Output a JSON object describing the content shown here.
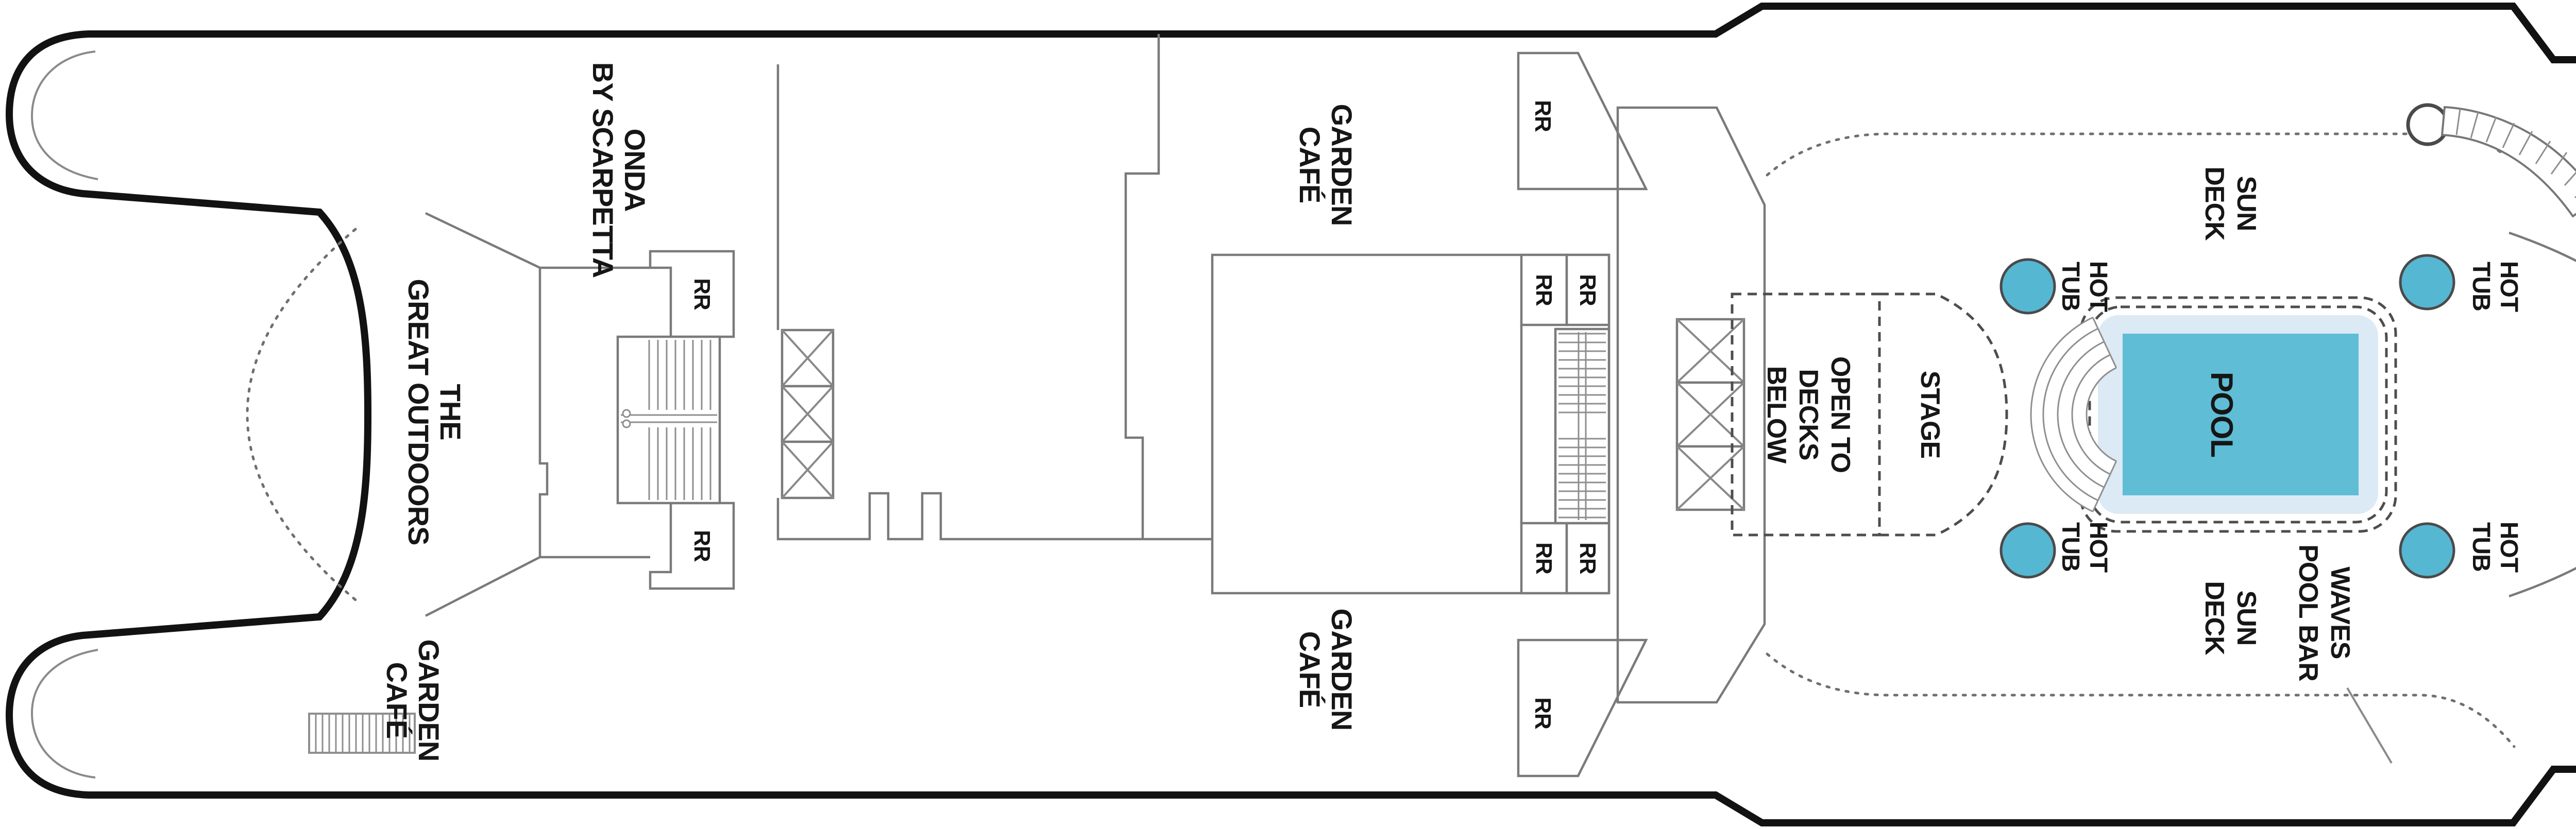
{
  "labels": {
    "onda": [
      "ONDA",
      "BY SCARPETTA"
    ],
    "great_outdoors": [
      "THE",
      "GREAT OUTDOORS"
    ],
    "garden_cafe": [
      "GARDEN",
      "CAFÉ"
    ],
    "restroom": "RR",
    "open_to_decks_below": [
      "OPEN TO",
      "DECKS",
      "BELOW"
    ],
    "stage": "STAGE",
    "pool": "POOL",
    "sun_deck": [
      "SUN",
      "DECK"
    ],
    "hot_tub": [
      "HOT",
      "TUB"
    ],
    "waves_pool_bar": [
      "WAVES",
      "POOL BAR"
    ],
    "spa_salon": "SPA & SALON",
    "pulse_fitness": [
      "PULSE",
      "FITNESS",
      "CENTER"
    ],
    "spinnaker": [
      "SPINNAKER",
      "OBSERVATION LOUNGE"
    ],
    "humidor": [
      "HUMIDOR",
      "CIGAR",
      "LOUNGE"
    ]
  },
  "colors": {
    "background": "#FFFFFF",
    "hull_outline": "#121212",
    "interior_wall": "#7A7A7A",
    "pool_water": "#5FBDD6",
    "pool_shelf": "#DCEAF5",
    "hot_tub_water": "#56B7D2",
    "label_text": "#161616"
  }
}
